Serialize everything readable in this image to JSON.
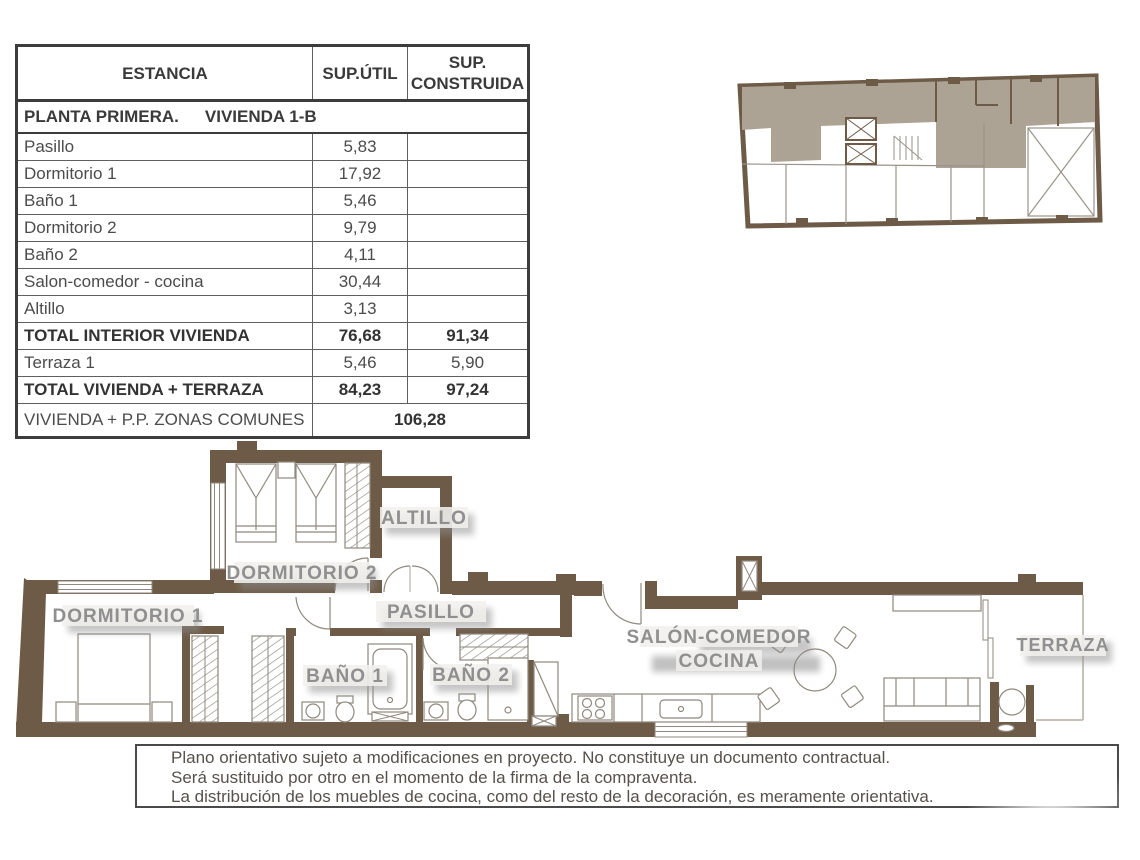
{
  "table": {
    "headers": {
      "estancia": "ESTANCIA",
      "sup_util": "SUP.ÚTIL",
      "sup_construida": "SUP. CONSTRUIDA"
    },
    "section_title_left": "PLANTA PRIMERA.",
    "section_title_right": "VIVIENDA 1-B",
    "rows": [
      {
        "name": "Pasillo",
        "util": "5,83",
        "construida": ""
      },
      {
        "name": "Dormitorio 1",
        "util": "17,92",
        "construida": ""
      },
      {
        "name": "Baño 1",
        "util": "5,46",
        "construida": ""
      },
      {
        "name": "Dormitorio 2",
        "util": "9,79",
        "construida": ""
      },
      {
        "name": "Baño 2",
        "util": "4,11",
        "construida": ""
      },
      {
        "name": "Salon-comedor - cocina",
        "util": "30,44",
        "construida": ""
      },
      {
        "name": "Altillo",
        "util": "3,13",
        "construida": ""
      }
    ],
    "total_interior": {
      "name": "TOTAL INTERIOR VIVIENDA",
      "util": "76,68",
      "construida": "91,34"
    },
    "terraza_row": {
      "name": "Terraza 1",
      "util": "5,46",
      "construida": "5,90"
    },
    "total_terraza": {
      "name": "TOTAL VIVIENDA + TERRAZA",
      "util": "84,23",
      "construida": "97,24"
    },
    "comunes": {
      "name": "VIVIENDA + P.P. ZONAS COMUNES",
      "value": "106,28"
    }
  },
  "plan": {
    "labels": {
      "altillo": "ALTILLO",
      "dormitorio2": "DORMITORIO 2",
      "dormitorio1": "DORMITORIO 1",
      "pasillo": "PASILLO",
      "bano1": "BAÑO 1",
      "bano2": "BAÑO 2",
      "salon_line1": "SALÓN-COMEDOR",
      "salon_line2": "COCINA",
      "terraza": "TERRAZA"
    },
    "colors": {
      "wall": "#6e5b47",
      "label_text": "#8f8f8f",
      "furniture_line": "#8f897d",
      "key_plan_highlight": "#ada395"
    }
  },
  "disclaimer": {
    "line1": "Plano orientativo sujeto a modificaciones en proyecto. No constituye un documento contractual.",
    "line2": "Será sustituido por otro en el momento de la firma de la compraventa.",
    "line3": "La distribución de los muebles de cocina, como del resto de la decoración, es meramente orientativa."
  }
}
